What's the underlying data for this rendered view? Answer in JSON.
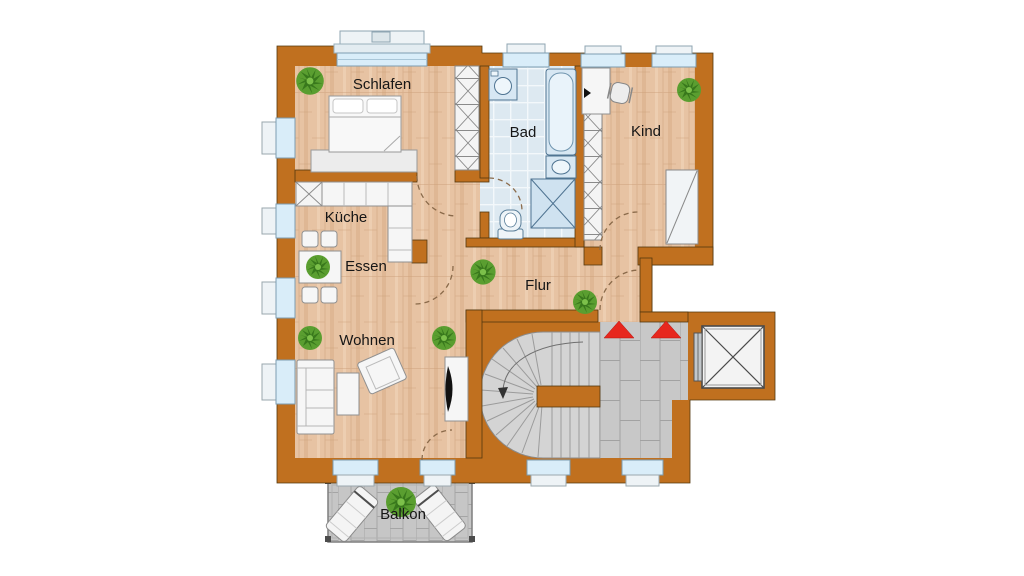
{
  "plan": {
    "type": "apartment-floor-plan",
    "rooms": [
      {
        "id": "schlafen",
        "label": "Schlafen"
      },
      {
        "id": "bad",
        "label": "Bad"
      },
      {
        "id": "kind",
        "label": "Kind"
      },
      {
        "id": "kueche",
        "label": "Küche"
      },
      {
        "id": "essen",
        "label": "Essen"
      },
      {
        "id": "flur",
        "label": "Flur"
      },
      {
        "id": "wohnen",
        "label": "Wohnen"
      },
      {
        "id": "balkon",
        "label": "Balkon"
      }
    ]
  },
  "colors": {
    "background": "#ffffff",
    "wall": "#c0701f",
    "wall_outline": "#53380f",
    "wood_floor": "#e7c3a3",
    "bath_tile": "#dde9f1",
    "stair_tread": "#d4d4d4",
    "paver_gray": "#c8c8c8",
    "window_glass": "#d9edf9",
    "stair_arrow_red": "#e7271e",
    "plant_green": "#5a9e30"
  }
}
